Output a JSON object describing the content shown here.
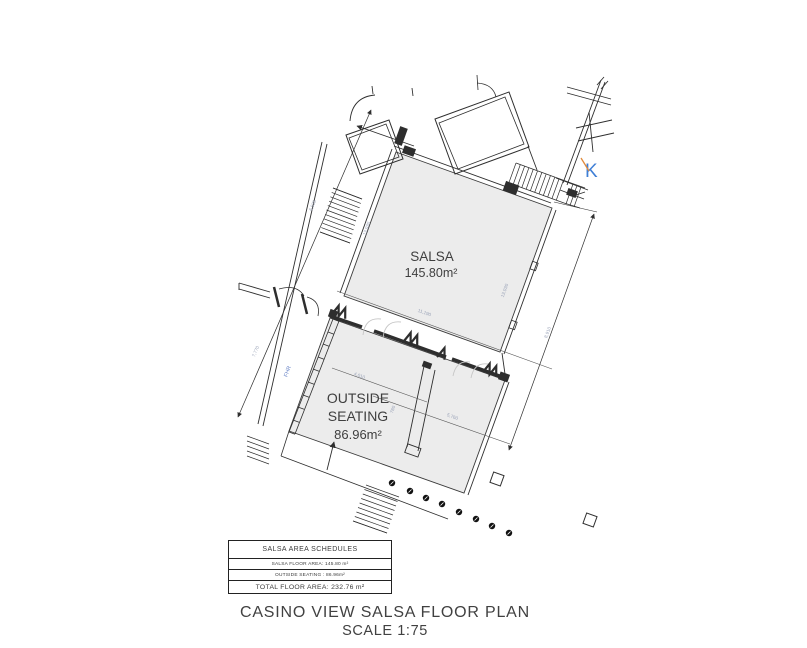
{
  "drawing": {
    "rooms": {
      "salsa": {
        "name": "SALSA",
        "area": "145.80m²"
      },
      "outside": {
        "line1": "OUTSIDE",
        "line2": "SEATING",
        "area": "86.96m²"
      }
    },
    "markers": {
      "k": "K",
      "fhr": "FHR"
    },
    "dims": {
      "left_outer_upper": "6,535",
      "left_outer_lower": "7,770",
      "left_wall": "13,030",
      "salsa_width": "11,190",
      "right_outer": "8,910",
      "right_wall": "13,030",
      "seating_door": "4,010",
      "seating_width": "5,760",
      "jut": "780"
    },
    "colors": {
      "room_fill": "#ececec",
      "wall": "#2e2e2e",
      "accent_blue": "#3f7fd6",
      "accent_orange": "#e08a3c"
    }
  },
  "schedule": {
    "title": "SALSA AREA SCHEDULES",
    "row_salsa": "SALSA FLOOR AREA: 145.80 m²",
    "row_outside": "OUTSIDE SEATING : 86.96m²",
    "row_total": "TOTAL FLOOR AREA: 232.76 m²"
  },
  "title_block": {
    "line1": "CASINO VIEW SALSA FLOOR PLAN",
    "line2": "SCALE 1:75"
  }
}
